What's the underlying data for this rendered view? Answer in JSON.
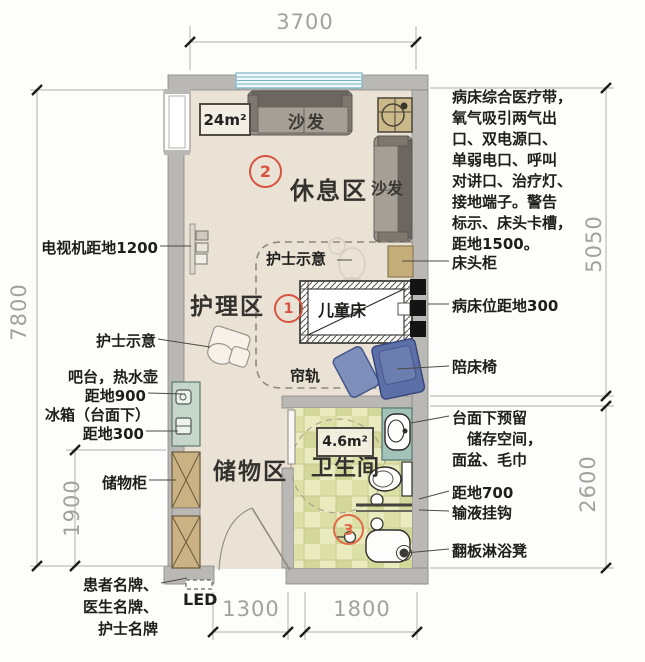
{
  "dimensions": {
    "top": "3700",
    "left": "7800",
    "left_inner": "1900",
    "right_upper": "5050",
    "right_lower": "2600",
    "bottom_left": "1300",
    "bottom_right": "1800"
  },
  "zones": {
    "rest_area": "休息区",
    "nursing_area": "护理区",
    "storage_area": "储物区",
    "bathroom": "卫生间",
    "room_area_label": "24m²",
    "bathroom_area_label": "4.6m²",
    "marker_1": "1",
    "marker_2": "2",
    "marker_3": "3"
  },
  "plan_labels": {
    "sofa_top": "沙发",
    "sofa_right": "沙发",
    "children_bed": "儿童床",
    "curtain_rail": "帘轨",
    "nurse_sign": "护士示意"
  },
  "left_annotations": {
    "tv": "电视机距地1200",
    "nurse_sign": "护士示意",
    "bar_kettle": "吧台，热水壶",
    "bar_height": "距地900",
    "fridge": "冰箱（台面下）",
    "fridge_height": "距地300",
    "storage_cabinet": "储物柜",
    "name_plates": "患者名牌、\n医生名牌、\n护士名牌",
    "led": "LED"
  },
  "right_annotations": {
    "medical_band": "病床综合医疗带，\n氧气吸引两气出\n口、双电源口、\n单弱电口、呼叫\n对讲口、治疗灯、\n接地端子。警告\n标示、床头卡槽，\n距地1500。",
    "bedside_table": "床头柜",
    "bed_height": "病床位距地300",
    "companion_chair": "陪床椅",
    "counter_note": "台面下预留\n　储存空间，\n面盆、毛巾",
    "hook_height": "距地700",
    "iv_hook": "输液挂钩",
    "shower_seat": "翻板淋浴凳"
  },
  "colors": {
    "floor": "#eae3d5",
    "wall": "#b9b8b4",
    "tile": "#dde0a8",
    "accent_red": "#d85340",
    "chair_blue": "#5c6fa6",
    "counter_teal": "#a3c2ba",
    "cabinet_tan": "#cbb284",
    "dim_gray": "#a3a19d"
  }
}
